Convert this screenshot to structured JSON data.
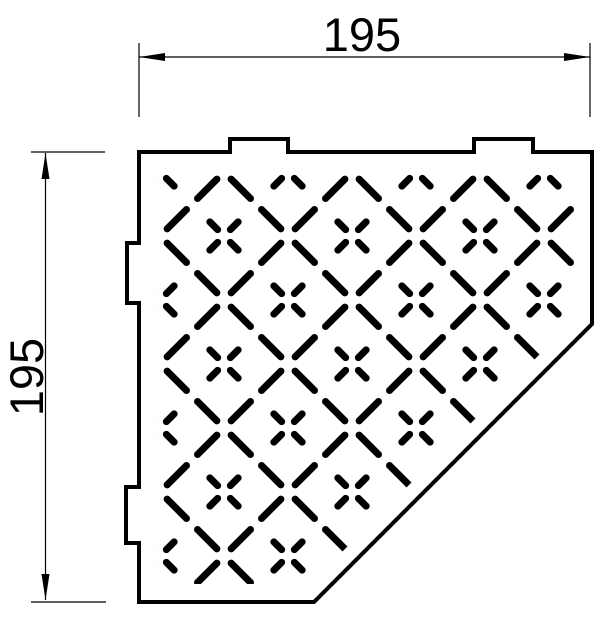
{
  "meta": {
    "title": "Corner shelf technical drawing",
    "view": "top view, pentagonal corner shelf with perforated cross pattern"
  },
  "canvas": {
    "w": 613,
    "h": 638,
    "bg": "#ffffff",
    "ink": "#000000"
  },
  "dimensions": {
    "style": {
      "stroke_w": 1.2,
      "arrow_len": 26,
      "arrow_halfw": 4,
      "font_size": 47
    },
    "top": {
      "label": "195",
      "line": {
        "x1": 139,
        "y1": 57,
        "x2": 590,
        "y2": 57
      },
      "ext": [
        {
          "x1": 139,
          "y1": 43,
          "x2": 139,
          "y2": 117
        },
        {
          "x1": 590,
          "y1": 43,
          "x2": 590,
          "y2": 117
        }
      ],
      "arrows": [
        {
          "tip": [
            139,
            57
          ],
          "dir": "left"
        },
        {
          "tip": [
            590,
            57
          ],
          "dir": "right"
        }
      ],
      "text": {
        "x": 362,
        "y": 51,
        "rotate": 0
      }
    },
    "left": {
      "label": "195",
      "line": {
        "x1": 45.5,
        "y1": 153,
        "x2": 45.5,
        "y2": 600
      },
      "ext": [
        {
          "x1": 31,
          "y1": 152,
          "x2": 105,
          "y2": 152
        },
        {
          "x1": 31,
          "y1": 602,
          "x2": 106,
          "y2": 602
        }
      ],
      "arrows": [
        {
          "tip": [
            45.5,
            153
          ],
          "dir": "up"
        },
        {
          "tip": [
            45.5,
            600
          ],
          "dir": "down"
        }
      ],
      "text": {
        "x": 43,
        "y": 377,
        "rotate": -90
      }
    }
  },
  "shelf": {
    "outline_path": "M 139,152 H 230 V 139 H 288 V 152 H 474 V 139 H 533 V 152 H 592 V 324 L 314,602 H 139 V 543 H 126 V 487 H 139 V 303 H 127 V 243 H 139 Z",
    "outline_stroke_w": 4,
    "pattern": {
      "clip": [
        [
          157,
          170
        ],
        [
          574,
          170
        ],
        [
          574,
          320
        ],
        [
          310,
          584
        ],
        [
          157,
          584
        ]
      ],
      "stroke_w": 7,
      "x_phase": 32,
      "cell": 64,
      "diag_down_c": [
        -436,
        -308,
        -180,
        -52,
        76,
        204,
        332
      ],
      "diag_up_d": [
        268,
        396,
        524,
        652,
        780,
        908
      ],
      "dash_x_spans": [
        [
          7.1,
          26.5
        ],
        [
          37.5,
          56.9
        ]
      ],
      "edge_x_range": [
        96,
        608
      ],
      "cross": {
        "origin": [
          224,
          236
        ],
        "r_in": 9,
        "r_out": 20,
        "i_range": [
          -2,
          6
        ],
        "j_range": [
          -2,
          6
        ]
      }
    }
  }
}
